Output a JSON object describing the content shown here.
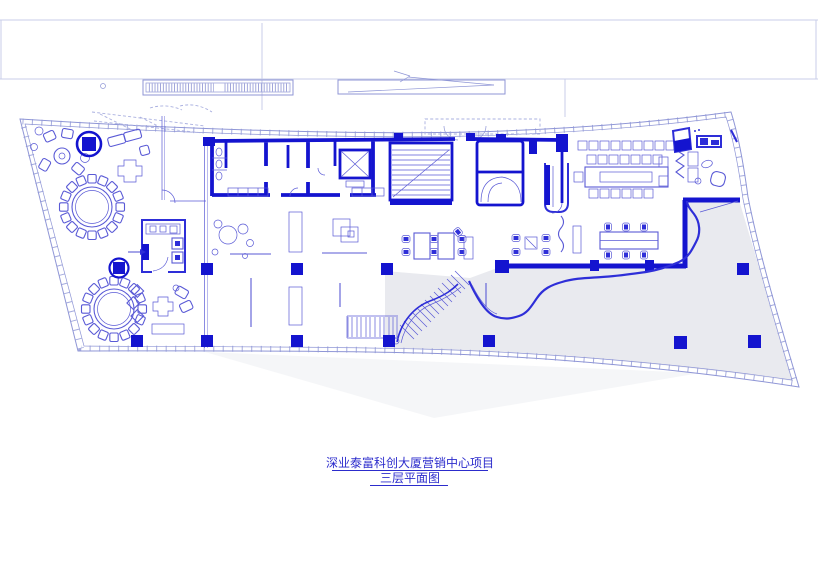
{
  "caption": {
    "line1": "深业泰富科创大厦营销中心项目",
    "line2": "三层平面图"
  },
  "colors": {
    "wall": "#1414cf",
    "wall_med": "#2e2ed8",
    "line": "#5a5ad6",
    "facade": "#8f96d6",
    "faint": "#c9cde8",
    "faint2": "#aab0e0",
    "terrace_fill": "#e9eaef",
    "shadow_fill": "#f6f6fa",
    "caption_text": "#2c2ccc"
  },
  "plan_elements": {
    "drawing_type": "floor-plan",
    "floor": "3F",
    "features": [
      "curved-floor-plate-facade",
      "lounge-seating-cluster",
      "round-banquet-table-1",
      "round-banquet-table-2",
      "fire-hydrant-marker-1",
      "fire-hydrant-marker-2",
      "pantry-room",
      "sofa-lounge",
      "exhibition-bubbles",
      "display-shelf-1",
      "display-shelf-2",
      "building-core-toilets",
      "elevator-shaft",
      "stair-shaft",
      "escape-shaft",
      "reception-desk",
      "conference-table",
      "workstation-cluster-a",
      "workstation-cluster-b",
      "workstation-cluster-c",
      "grand-staircase",
      "landscape-wall",
      "terrace",
      "structural-columns",
      "roof-louvre",
      "ramp-arrow"
    ]
  }
}
